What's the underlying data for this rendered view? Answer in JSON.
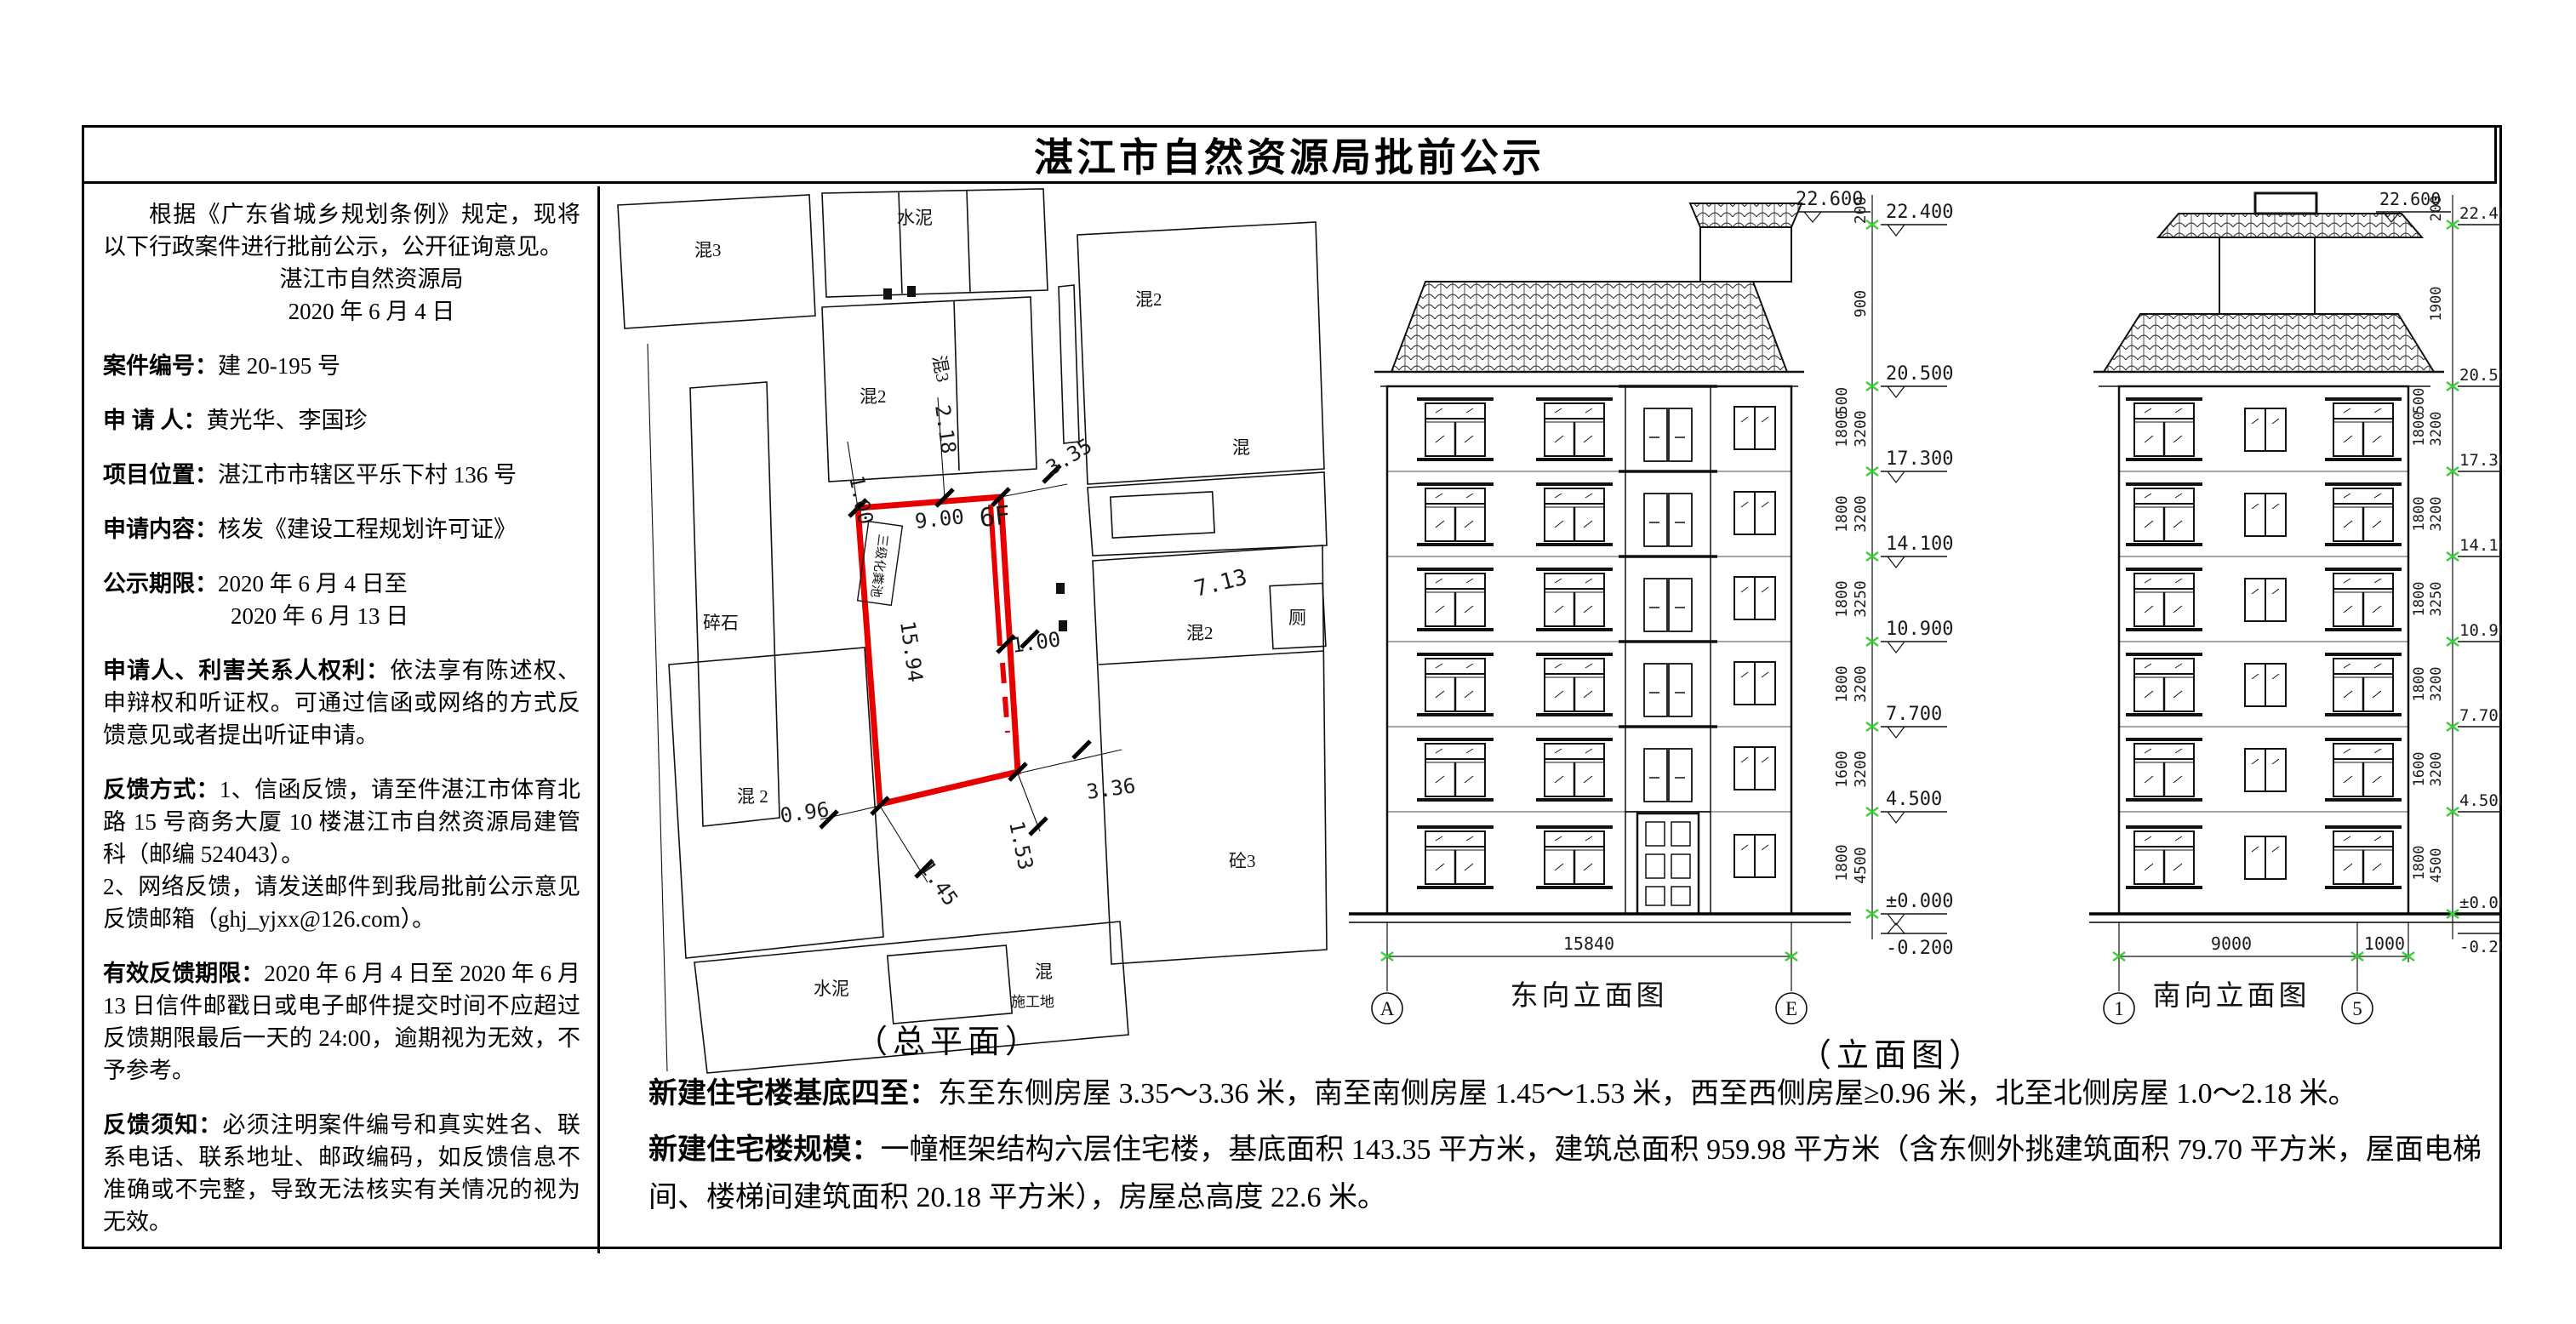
{
  "title": "湛江市自然资源局批前公示",
  "left_panel": {
    "intro": "根据《广东省城乡规划条例》规定，现将以下行政案件进行批前公示，公开征询意见。",
    "agency": "湛江市自然资源局",
    "date": "2020 年 6 月 4 日",
    "case_no_label": "案件编号：",
    "case_no": "建 20-195 号",
    "applicant_label": "申 请 人：",
    "applicant": "黄光华、李国珍",
    "location_label": "项目位置：",
    "location": "湛江市市辖区平乐下村 136 号",
    "request_label": "申请内容：",
    "request": "核发《建设工程规划许可证》",
    "period_label": "公示期限：",
    "period_from": "2020 年 6 月 4 日至",
    "period_to": "2020 年 6 月 13 日",
    "rights_label": "申请人、利害关系人权利：",
    "rights": "依法享有陈述权、申辩权和听证权。可通过信函或网络的方式反馈意见或者提出听证申请。",
    "feedback_label": "反馈方式：",
    "feedback_mail": "1、信函反馈，请至件湛江市体育北路 15 号商务大厦 10 楼湛江市自然资源局建管科（邮编 524043）。",
    "feedback_net": "2、网络反馈，请发送邮件到我局批前公示意见反馈邮箱（ghj_yjxx@126.com）。",
    "valid_label": "有效反馈期限：",
    "valid_text": "2020 年 6 月 4 日至 2020 年 6 月 13 日信件邮戳日或电子邮件提交时间不应超过反馈期限最后一天的 24:00，逾期视为无效，不予参考。",
    "notice_label": "反馈须知：",
    "notice_text": "必须注明案件编号和真实姓名、联系电话、联系地址、邮政编码，如反馈信息不准确或不完整，导致无法核实有关情况的视为无效。"
  },
  "site_plan": {
    "caption": "（总平面）",
    "red_color": "#e60000",
    "green_color": "#3fcf3f",
    "plot": {
      "floors": "6F",
      "width": "9.00",
      "depth": "15.94",
      "septic": "三级化粪池"
    },
    "dims": {
      "north_gap_a": "1.00",
      "north_gap_b": "2.18",
      "east_gap_top": "3.35",
      "east_mid": "1.00",
      "east_gap_bottom": "3.36",
      "south_gap_a": "1.45",
      "south_gap_b": "1.53",
      "west_gap": "0.96",
      "neighbor_height": "7.13"
    },
    "labels": [
      "混3",
      "水泥",
      "混2",
      "混3",
      "混2",
      "混",
      "厕",
      "混2",
      "砼3",
      "碎石",
      "混 2",
      "水泥",
      "混",
      "施工地"
    ]
  },
  "elevations": {
    "caption": "（立面图）",
    "east": {
      "name": "东向立面图",
      "axis_left": "A",
      "axis_right": "E",
      "width_dim": "15840"
    },
    "south": {
      "name": "南向立面图",
      "axis_left": "1",
      "axis_right": "5",
      "dim_main": "9000",
      "dim_side": "1000"
    },
    "levels": [
      "22.600",
      "22.400",
      "20.500",
      "17.300",
      "14.100",
      "10.900",
      "7.700",
      "4.500",
      "±0.000",
      "-0.200"
    ],
    "storey_dims": [
      "3200",
      "3200",
      "3250",
      "3200",
      "3200",
      "4500"
    ],
    "window_dims": [
      "1800",
      "1800",
      "1800",
      "1800",
      "1600",
      "1800"
    ],
    "small_dims": {
      "s200": "200",
      "s900": "900",
      "s1900": "1900",
      "s500": "500"
    }
  },
  "bottom": {
    "p1_label": "新建住宅楼基底四至：",
    "p1_text": "东至东侧房屋 3.35～3.36 米，南至南侧房屋 1.45～1.53 米，西至西侧房屋≥0.96 米，北至北侧房屋 1.0～2.18 米。",
    "p2_label": "新建住宅楼规模：",
    "p2_text": "一幢框架结构六层住宅楼，基底面积 143.35 平方米，建筑总面积 959.98 平方米（含东侧外挑建筑面积 79.70 平方米，屋面电梯间、楼梯间建筑面积 20.18 平方米），房屋总高度 22.6 米。"
  }
}
